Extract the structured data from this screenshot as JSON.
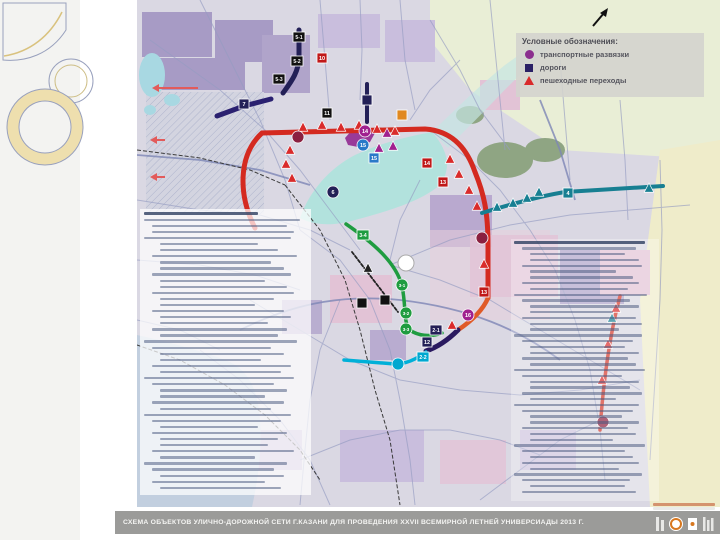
{
  "slide": {
    "background": "#ffffff",
    "accent_beige": "#eedfae",
    "accent_outline": "#98a0bd"
  },
  "legend": {
    "title": "Условные обозначения:",
    "items": [
      {
        "icon": "interchange-circle",
        "color": "#8b2f8f",
        "label": "транспортные развязки"
      },
      {
        "icon": "road-square",
        "color": "#2a2065",
        "label": "дороги"
      },
      {
        "icon": "crossing-triangle",
        "color": "#d92b2b",
        "label": "пешеходные переходы"
      }
    ]
  },
  "title_bar": {
    "caption": "СХЕМА ОБЪЕКТОВ УЛИЧНО-ДОРОЖНОЙ СЕТИ Г.КАЗАНИ ДЛЯ ПРОВЕДЕНИЯ XXVII ВСЕМИРНОЙ ЛЕТНЕЙ УНИВЕРСИАДЫ 2013 Г.",
    "bar_color": "#9b9b99"
  },
  "map": {
    "roads": [
      {
        "name": "ring-road-red",
        "d": "M255,228 C238,195 238,155 262,133 L425,129 C455,131 468,152 475,172 C484,194 488,212 488,245 L488,298",
        "color": "#d42a20",
        "w": 5
      },
      {
        "name": "ring-road-red-transition",
        "d": "M488,298 C482,312 470,322 458,330",
        "color": "#e05a28",
        "w": 4.5
      },
      {
        "name": "east-road-red",
        "d": "M620,296 C611,330 604,372 600,430",
        "color": "#d4382a",
        "w": 3.5
      },
      {
        "name": "northeast-road-teal",
        "d": "M482,213 C505,206 540,196 565,192 L663,186",
        "color": "#177f92",
        "w": 4
      },
      {
        "name": "north-road-navy",
        "d": "M299,30 L299,56 C299,72 291,82 283,93",
        "color": "#232057",
        "w": 5
      },
      {
        "name": "road-7-navy",
        "d": "M217,116 L244,106 L271,99",
        "color": "#2a2070",
        "w": 5
      },
      {
        "name": "road-9-navy",
        "d": "M367,84 L367,122",
        "color": "#232057",
        "w": 4
      },
      {
        "name": "south-road-navy",
        "d": "M458,330 C448,340 438,347 426,351",
        "color": "#2a1a60",
        "w": 5
      },
      {
        "name": "south-road-cyan",
        "d": "M426,352 C414,361 404,364 395,364 L344,360",
        "color": "#00b0d8",
        "w": 3.5
      },
      {
        "name": "central-road-green",
        "d": "M346,224 C372,242 396,262 402,286 C407,310 402,326 413,332 C423,337 434,336 442,333",
        "color": "#1f9c40",
        "w": 3.5
      },
      {
        "name": "dashed-road-black",
        "d": "M352,252 L398,312",
        "color": "#222222",
        "w": 1.8,
        "dash": "3 2"
      }
    ],
    "square_markers": [
      {
        "label": "5-1",
        "x": 299,
        "y": 37,
        "color": "#111111"
      },
      {
        "label": "5-2",
        "x": 297,
        "y": 61,
        "color": "#111111"
      },
      {
        "label": "5-3",
        "x": 279,
        "y": 79,
        "color": "#111111"
      },
      {
        "label": "7",
        "x": 244,
        "y": 104,
        "color": "#232057"
      },
      {
        "label": "",
        "x": 367,
        "y": 100,
        "color": "#232057"
      },
      {
        "label": "10",
        "x": 322,
        "y": 58,
        "color": "#c01818"
      },
      {
        "label": "11",
        "x": 327,
        "y": 113,
        "color": "#111111"
      },
      {
        "label": "",
        "x": 402,
        "y": 115,
        "color": "#e08820"
      },
      {
        "label": "15",
        "x": 374,
        "y": 158,
        "color": "#2979c8"
      },
      {
        "label": "14",
        "x": 427,
        "y": 163,
        "color": "#c01818"
      },
      {
        "label": "13",
        "x": 443,
        "y": 182,
        "color": "#c01818"
      },
      {
        "label": "13",
        "x": 484,
        "y": 292,
        "color": "#c01818"
      },
      {
        "label": "4",
        "x": 568,
        "y": 193,
        "color": "#177f92"
      },
      {
        "label": "2-1",
        "x": 436,
        "y": 330,
        "color": "#232057"
      },
      {
        "label": "12",
        "x": 427,
        "y": 342,
        "color": "#232057"
      },
      {
        "label": "2-2",
        "x": 423,
        "y": 357,
        "color": "#00a8d0"
      },
      {
        "label": "3-4",
        "x": 363,
        "y": 235,
        "color": "#1f9c40"
      },
      {
        "label": "",
        "x": 385,
        "y": 300,
        "color": "#111111"
      },
      {
        "label": "",
        "x": 362,
        "y": 303,
        "color": "#111111"
      }
    ],
    "circle_markers": [
      {
        "label": "14",
        "x": 365,
        "y": 131,
        "color": "#a0218f"
      },
      {
        "label": "15",
        "x": 363,
        "y": 145,
        "color": "#2979c8"
      },
      {
        "label": "6",
        "x": 333,
        "y": 192,
        "color": "#232057"
      },
      {
        "label": "16",
        "x": 468,
        "y": 315,
        "color": "#a0218f"
      },
      {
        "label": "",
        "x": 482,
        "y": 238,
        "color": "#8b2040"
      },
      {
        "label": "",
        "x": 603,
        "y": 422,
        "color": "#8b2040"
      },
      {
        "label": "3-1",
        "x": 402,
        "y": 285,
        "color": "#1f9c40"
      },
      {
        "label": "3-2",
        "x": 406,
        "y": 313,
        "color": "#1f9c40"
      },
      {
        "label": "3-3",
        "x": 406,
        "y": 329,
        "color": "#1f9c40"
      },
      {
        "label": "",
        "x": 398,
        "y": 364,
        "color": "#00a8d0"
      },
      {
        "label": "",
        "x": 298,
        "y": 137,
        "color": "#8b2040"
      }
    ],
    "triangle_markers": [
      {
        "x": 303,
        "y": 127,
        "c": "#d92b2b"
      },
      {
        "x": 322,
        "y": 125,
        "c": "#d92b2b"
      },
      {
        "x": 341,
        "y": 127,
        "c": "#d92b2b"
      },
      {
        "x": 359,
        "y": 125,
        "c": "#d92b2b"
      },
      {
        "x": 377,
        "y": 129,
        "c": "#d92b2b"
      },
      {
        "x": 395,
        "y": 131,
        "c": "#d92b2b"
      },
      {
        "x": 290,
        "y": 150,
        "c": "#d92b2b"
      },
      {
        "x": 286,
        "y": 164,
        "c": "#d92b2b"
      },
      {
        "x": 292,
        "y": 178,
        "c": "#d92b2b"
      },
      {
        "x": 450,
        "y": 159,
        "c": "#d92b2b"
      },
      {
        "x": 459,
        "y": 174,
        "c": "#d92b2b"
      },
      {
        "x": 469,
        "y": 190,
        "c": "#d92b2b"
      },
      {
        "x": 477,
        "y": 206,
        "c": "#d92b2b"
      },
      {
        "x": 484,
        "y": 264,
        "c": "#d92b2b"
      },
      {
        "x": 452,
        "y": 325,
        "c": "#d92b2b"
      },
      {
        "x": 616,
        "y": 308,
        "c": "#d92b2b"
      },
      {
        "x": 608,
        "y": 344,
        "c": "#d92b2b"
      },
      {
        "x": 602,
        "y": 380,
        "c": "#d92b2b"
      },
      {
        "x": 387,
        "y": 133,
        "c": "#a0218f"
      },
      {
        "x": 393,
        "y": 146,
        "c": "#a0218f"
      },
      {
        "x": 379,
        "y": 148,
        "c": "#a0218f"
      },
      {
        "x": 539,
        "y": 192,
        "c": "#177f92"
      },
      {
        "x": 527,
        "y": 198,
        "c": "#177f92"
      },
      {
        "x": 513,
        "y": 203,
        "c": "#177f92"
      },
      {
        "x": 497,
        "y": 207,
        "c": "#177f92"
      },
      {
        "x": 649,
        "y": 188,
        "c": "#177f92"
      },
      {
        "x": 612,
        "y": 318,
        "c": "#177f92"
      },
      {
        "x": 368,
        "y": 268,
        "c": "#222222"
      }
    ],
    "west_arrows": [
      {
        "x": 152,
        "y": 88,
        "len": 46
      },
      {
        "x": 150,
        "y": 140,
        "len": 15
      },
      {
        "x": 150,
        "y": 177,
        "len": 15
      }
    ]
  },
  "left_panel": {
    "note": "numbered list, text too small to read",
    "lines": [
      [
        0,
        70
      ],
      [
        0,
        96
      ],
      [
        1,
        88
      ],
      [
        1,
        92
      ],
      [
        0,
        90
      ],
      [
        2,
        70
      ],
      [
        2,
        82
      ],
      [
        1,
        94
      ],
      [
        2,
        78
      ],
      [
        2,
        86
      ],
      [
        1,
        90
      ],
      [
        2,
        74
      ],
      [
        2,
        88
      ],
      [
        1,
        92
      ],
      [
        2,
        80
      ],
      [
        2,
        68
      ],
      [
        1,
        86
      ],
      [
        2,
        90
      ],
      [
        2,
        76
      ],
      [
        1,
        88
      ],
      [
        2,
        82
      ],
      [
        0,
        94
      ],
      [
        1,
        78
      ],
      [
        2,
        86
      ],
      [
        2,
        72
      ],
      [
        1,
        90
      ],
      [
        2,
        84
      ],
      [
        0,
        92
      ],
      [
        1,
        80
      ],
      [
        2,
        88
      ],
      [
        2,
        74
      ],
      [
        1,
        86
      ],
      [
        2,
        78
      ],
      [
        0,
        90
      ],
      [
        1,
        84
      ],
      [
        2,
        70
      ],
      [
        1,
        88
      ],
      [
        2,
        82
      ],
      [
        2,
        76
      ],
      [
        1,
        92
      ],
      [
        2,
        68
      ],
      [
        0,
        88
      ],
      [
        1,
        80
      ],
      [
        2,
        86
      ],
      [
        1,
        74
      ],
      [
        2,
        84
      ]
    ]
  },
  "right_panel": {
    "note": "numbered list, text too small to read",
    "lines": [
      [
        0,
        92
      ],
      [
        1,
        86
      ],
      [
        2,
        78
      ],
      [
        2,
        88
      ],
      [
        1,
        90
      ],
      [
        2,
        72
      ],
      [
        2,
        84
      ],
      [
        1,
        88
      ],
      [
        2,
        80
      ],
      [
        0,
        94
      ],
      [
        1,
        82
      ],
      [
        2,
        88
      ],
      [
        2,
        70
      ],
      [
        1,
        86
      ],
      [
        2,
        90
      ],
      [
        2,
        74
      ],
      [
        0,
        90
      ],
      [
        1,
        84
      ],
      [
        2,
        78
      ],
      [
        2,
        88
      ],
      [
        1,
        80
      ],
      [
        2,
        86
      ],
      [
        0,
        92
      ],
      [
        1,
        76
      ],
      [
        2,
        88
      ],
      [
        2,
        82
      ],
      [
        1,
        90
      ],
      [
        2,
        72
      ],
      [
        0,
        88
      ],
      [
        1,
        84
      ],
      [
        2,
        76
      ],
      [
        2,
        88
      ],
      [
        1,
        80
      ],
      [
        2,
        86
      ],
      [
        2,
        70
      ],
      [
        0,
        92
      ],
      [
        1,
        78
      ],
      [
        2,
        84
      ],
      [
        1,
        88
      ],
      [
        2,
        74
      ],
      [
        0,
        90
      ],
      [
        1,
        82
      ],
      [
        2,
        78
      ],
      [
        1,
        86
      ]
    ]
  }
}
